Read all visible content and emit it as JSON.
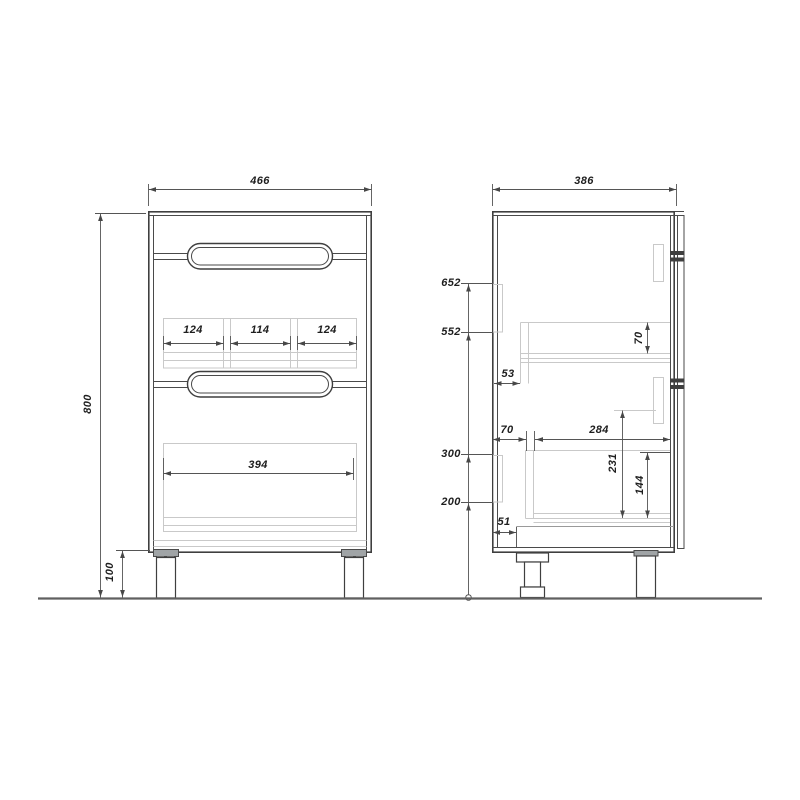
{
  "drawing": {
    "type": "furniture-technical-drawing",
    "views": [
      "front",
      "side"
    ],
    "colors": {
      "outline": "#3f3f3f",
      "hidden_line": "#c9c9c9",
      "plate_fill": "#a0a4a6",
      "ground": "#606060",
      "label_text": "#1e1e1e"
    },
    "front_view": {
      "width_mm": "466",
      "height_mm": "800",
      "leg_height_mm": "100",
      "middle_drawer_sections_mm": [
        "124",
        "114",
        "124"
      ],
      "bottom_drawer_inner_width_mm": "394"
    },
    "side_view": {
      "depth_mm": "386",
      "height_levels_mm": [
        "652",
        "552",
        "300",
        "200"
      ],
      "upper_drawer_back_gap_mm": "53",
      "upper_drawer_box_height_mm": "70",
      "lower_drawer_back_gap_mm": "70",
      "lower_drawer_length_mm": "284",
      "lower_drawer_front_height_mm": "231",
      "lower_drawer_box_height_mm": "144",
      "bottom_panel_recess_mm": "51"
    }
  }
}
